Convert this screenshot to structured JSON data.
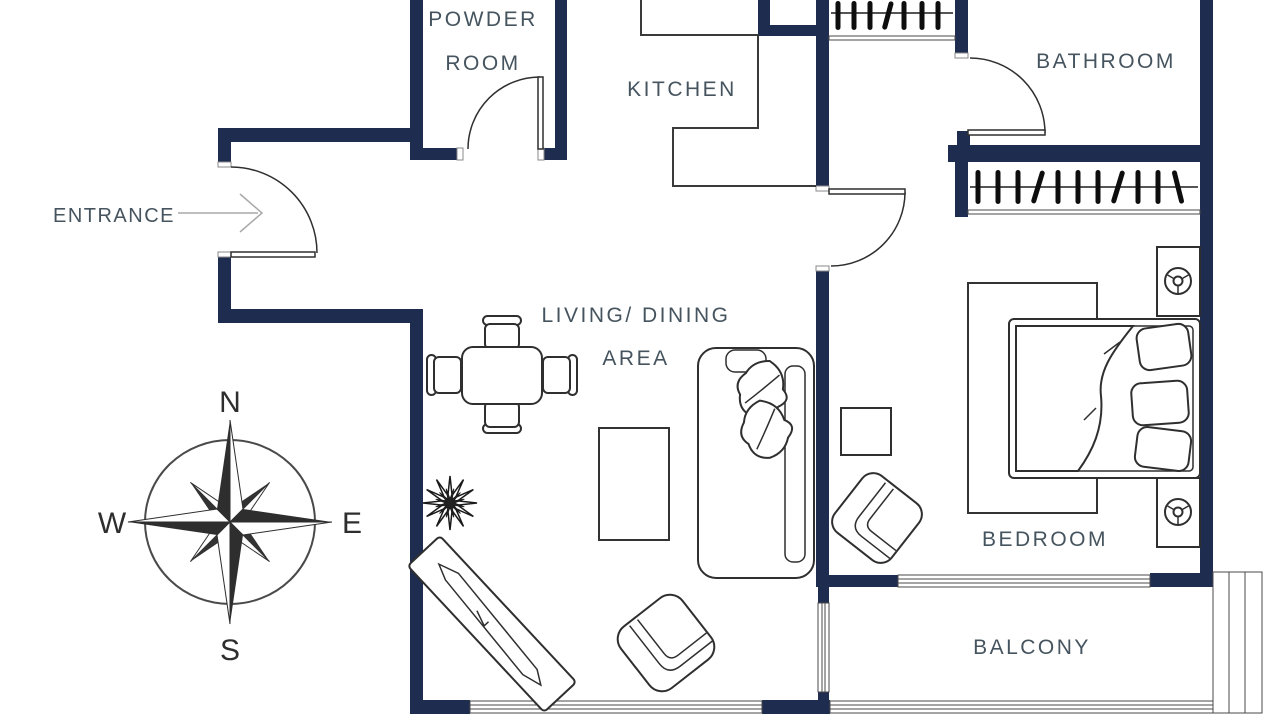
{
  "rooms": {
    "powder_room": {
      "label_line1": "POWDER",
      "label_line2": "ROOM"
    },
    "kitchen": {
      "label": "KITCHEN"
    },
    "bathroom": {
      "label": "BATHROOM"
    },
    "living_dining": {
      "label_line1": "LIVING/ DINING",
      "label_line2": "AREA"
    },
    "bedroom": {
      "label": "BEDROOM"
    },
    "balcony": {
      "label": "BALCONY"
    }
  },
  "entrance": {
    "label": "ENTRANCE"
  },
  "compass": {
    "north": "N",
    "south": "S",
    "east": "E",
    "west": "W"
  },
  "colors": {
    "wall": "#1e2c4f",
    "line": "#2f2f2f",
    "label": "#45545e",
    "arrow": "#a9a9a9"
  }
}
